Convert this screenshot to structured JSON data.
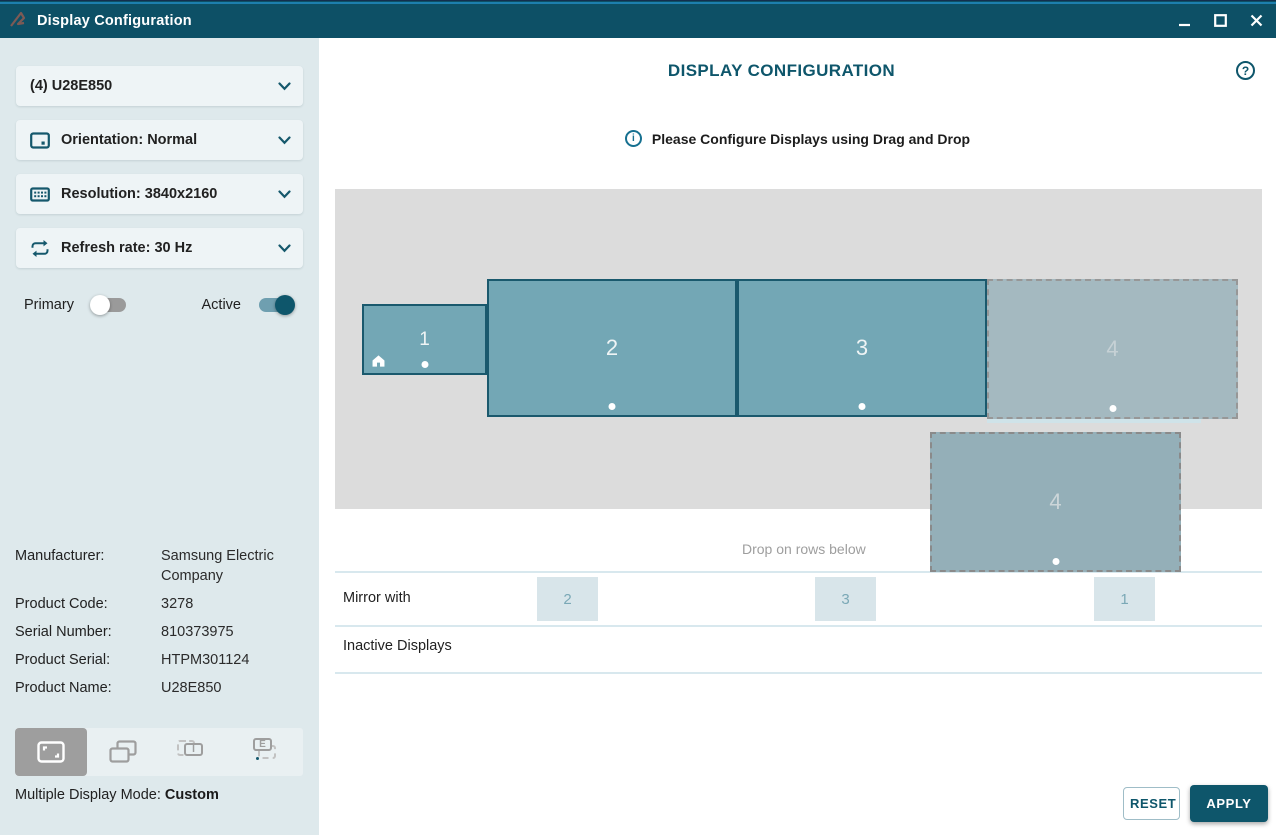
{
  "window": {
    "title": "Display Configuration"
  },
  "sidebar": {
    "selectors": [
      {
        "label": "(4) U28E850"
      },
      {
        "label": "Orientation: Normal"
      },
      {
        "label": "Resolution: 3840x2160"
      },
      {
        "label": "Refresh rate: 30 Hz"
      }
    ],
    "toggles": {
      "primary": {
        "label": "Primary",
        "state": "off"
      },
      "active": {
        "label": "Active",
        "state": "on"
      }
    },
    "info": {
      "rows": [
        {
          "label": "Manufacturer:",
          "value": "Samsung Electric Company"
        },
        {
          "label": "Product Code:",
          "value": "3278"
        },
        {
          "label": "Serial Number:",
          "value": "810373975"
        },
        {
          "label": "Product Serial:",
          "value": "HTPM301124"
        },
        {
          "label": "Product Name:",
          "value": "U28E850"
        }
      ]
    },
    "mode": {
      "label": "Multiple Display Mode: ",
      "value": "Custom",
      "selected_index": 0
    }
  },
  "main": {
    "title": "DISPLAY CONFIGURATION",
    "hint": "Please Configure Displays using Drag and Drop",
    "canvas": {
      "displays": [
        {
          "number": "1",
          "state": "active",
          "has_home_icon": true
        },
        {
          "number": "2",
          "state": "active"
        },
        {
          "number": "3",
          "state": "active"
        },
        {
          "number": "4",
          "state": "drop-placeholder"
        },
        {
          "number": "4",
          "state": "dragging"
        }
      ]
    },
    "drop_hint": "Drop on rows below",
    "mirror": {
      "label": "Mirror with",
      "targets": [
        "2",
        "3",
        "1"
      ]
    },
    "inactive": {
      "label": "Inactive Displays"
    },
    "buttons": {
      "reset": "RESET",
      "apply": "APPLY"
    }
  },
  "icons": {
    "help": "?",
    "info": "i",
    "mode_internal_letter": "I",
    "mode_external_letter": "E"
  },
  "colors": {
    "titlebar": "#0d5066",
    "accent": "#0e566b",
    "sidebar_bg": "#dee9ec",
    "canvas_bg": "#dcdcdc",
    "display_fill": "#73a7b5",
    "display_border": "#1a596d",
    "placeholder_fill": "#a4b9c0",
    "dragging_fill": "#94afb8",
    "mirror_square": "#d8e5ea",
    "toggle_on": "#0e566b"
  }
}
